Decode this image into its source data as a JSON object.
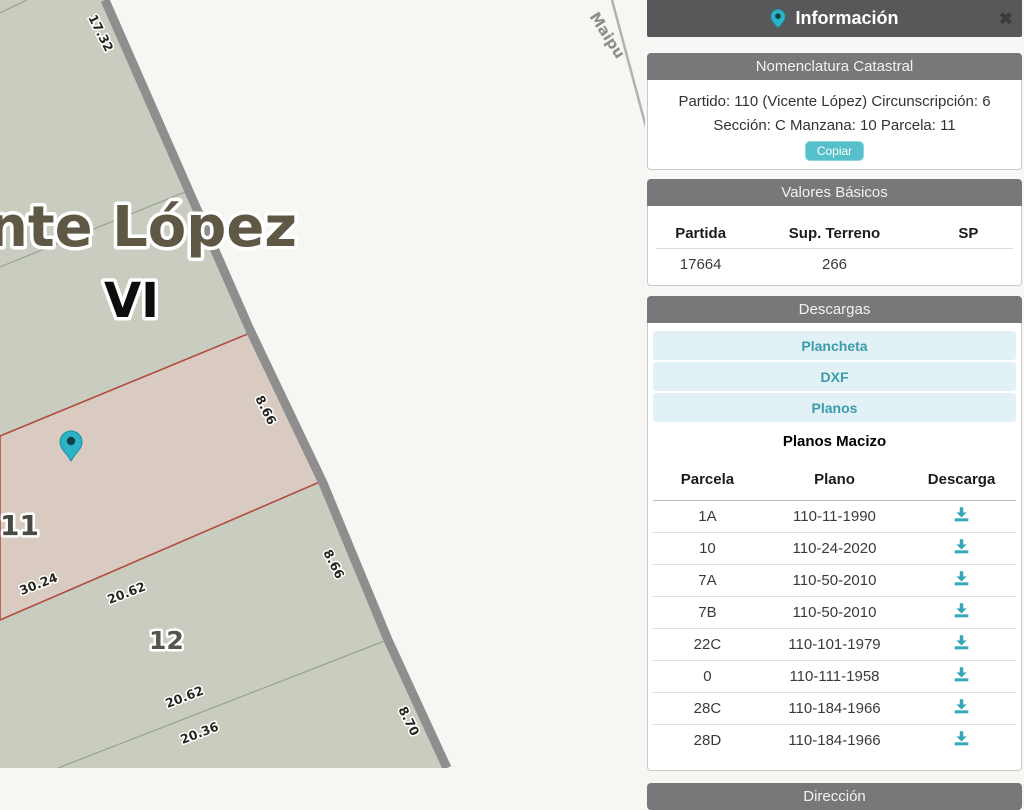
{
  "panel": {
    "title": "Información",
    "close_label": "✖",
    "nomenclatura": {
      "header": "Nomenclatura Catastral",
      "line1": "Partido: 110 (Vicente López) Circunscripción: 6",
      "line2": "Sección: C Manzana: 10 Parcela: 11",
      "copy_button": "Copiar"
    },
    "valores": {
      "header": "Valores Básicos",
      "columns": [
        "Partida",
        "Sup. Terreno",
        "SP"
      ],
      "row": {
        "partida": "17664",
        "sup_terreno": "266",
        "sp": ""
      }
    },
    "descargas": {
      "header": "Descargas",
      "links": [
        "Plancheta",
        "DXF",
        "Planos"
      ],
      "subheader": "Planos Macizo",
      "table": {
        "columns": [
          "Parcela",
          "Plano",
          "Descarga"
        ],
        "rows": [
          {
            "parcela": "1A",
            "plano": "110-11-1990"
          },
          {
            "parcela": "10",
            "plano": "110-24-2020"
          },
          {
            "parcela": "7A",
            "plano": "110-50-2010"
          },
          {
            "parcela": "7B",
            "plano": "110-50-2010"
          },
          {
            "parcela": "22C",
            "plano": "110-101-1979"
          },
          {
            "parcela": "0",
            "plano": "110-111-1958"
          },
          {
            "parcela": "28C",
            "plano": "110-184-1966"
          },
          {
            "parcela": "28D",
            "plano": "110-184-1966"
          }
        ]
      }
    },
    "direccion": {
      "header": "Dirección"
    }
  },
  "map": {
    "labels": {
      "district": "nte López",
      "section": "VI",
      "parcel_selected": "11",
      "parcel_below": "12",
      "street": "Maipu"
    },
    "dims": {
      "d17": "17.32",
      "d866a": "8.66",
      "d866b": "8.66",
      "d870": "8.70",
      "d3024": "30.24",
      "d2062a": "20.62",
      "d2062b": "20.62",
      "d2036": "20.36"
    }
  },
  "colors": {
    "accent_teal": "#55bfca",
    "link_teal": "#3a9cab",
    "title_gray": "#58585b",
    "header_gray": "#78787b",
    "block_fill": "#c9cdbf",
    "street_fill": "#f6f6f3",
    "selected_parcel_fill": "#d9cbc1",
    "selected_parcel_border": "#b24b40",
    "marker_teal": "#2cb3c6"
  }
}
